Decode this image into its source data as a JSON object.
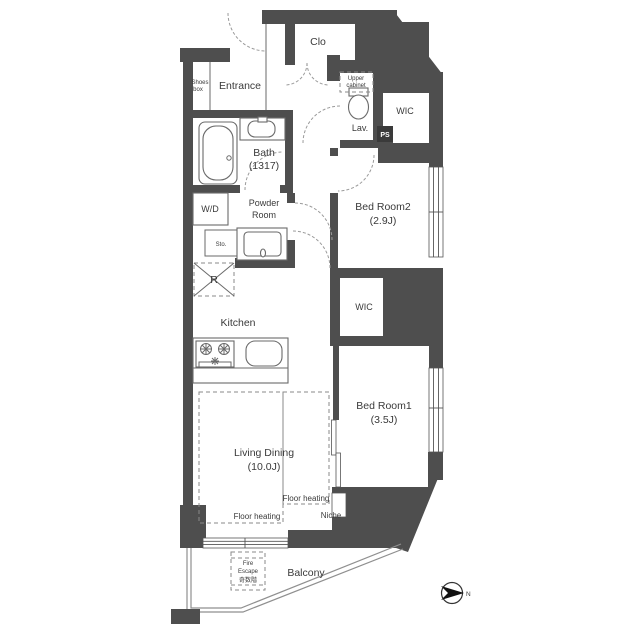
{
  "floorplan": {
    "title": "apartment-floor-plan",
    "labels": {
      "clo": "Clo",
      "entrance": "Entrance",
      "shoes_box_1": "Shoes",
      "shoes_box_2": "box",
      "upper_cabinet_1": "Upper",
      "upper_cabinet_2": "cabinet",
      "lav": "Lav.",
      "ps": "PS",
      "wic_upper": "WIC",
      "bedroom2_name": "Bed Room2",
      "bedroom2_size": "(2.9J)",
      "bath_name": "Bath",
      "bath_size": "(1317)",
      "wd": "W/D",
      "powder_1": "Powder",
      "powder_2": "Room",
      "sto": "Sto.",
      "fridge": "R",
      "wic_lower": "WIC",
      "kitchen": "Kitchen",
      "bedroom1_name": "Bed Room1",
      "bedroom1_size": "(3.5J)",
      "living_name": "Living Dining",
      "living_size": "(10.0J)",
      "floor_heating_right": "Floor heating",
      "floor_heating_left": "Floor heating",
      "niche": "Niche",
      "fire_escape_1": "Fire",
      "fire_escape_2": "Escape",
      "fire_escape_3": "奇数階",
      "balcony": "Balcony",
      "compass_n": "N"
    },
    "colors": {
      "wall": "#4e4e4e",
      "background": "#ffffff",
      "line": "#6a6a6a",
      "ps_box": "#3a3a3a"
    }
  }
}
